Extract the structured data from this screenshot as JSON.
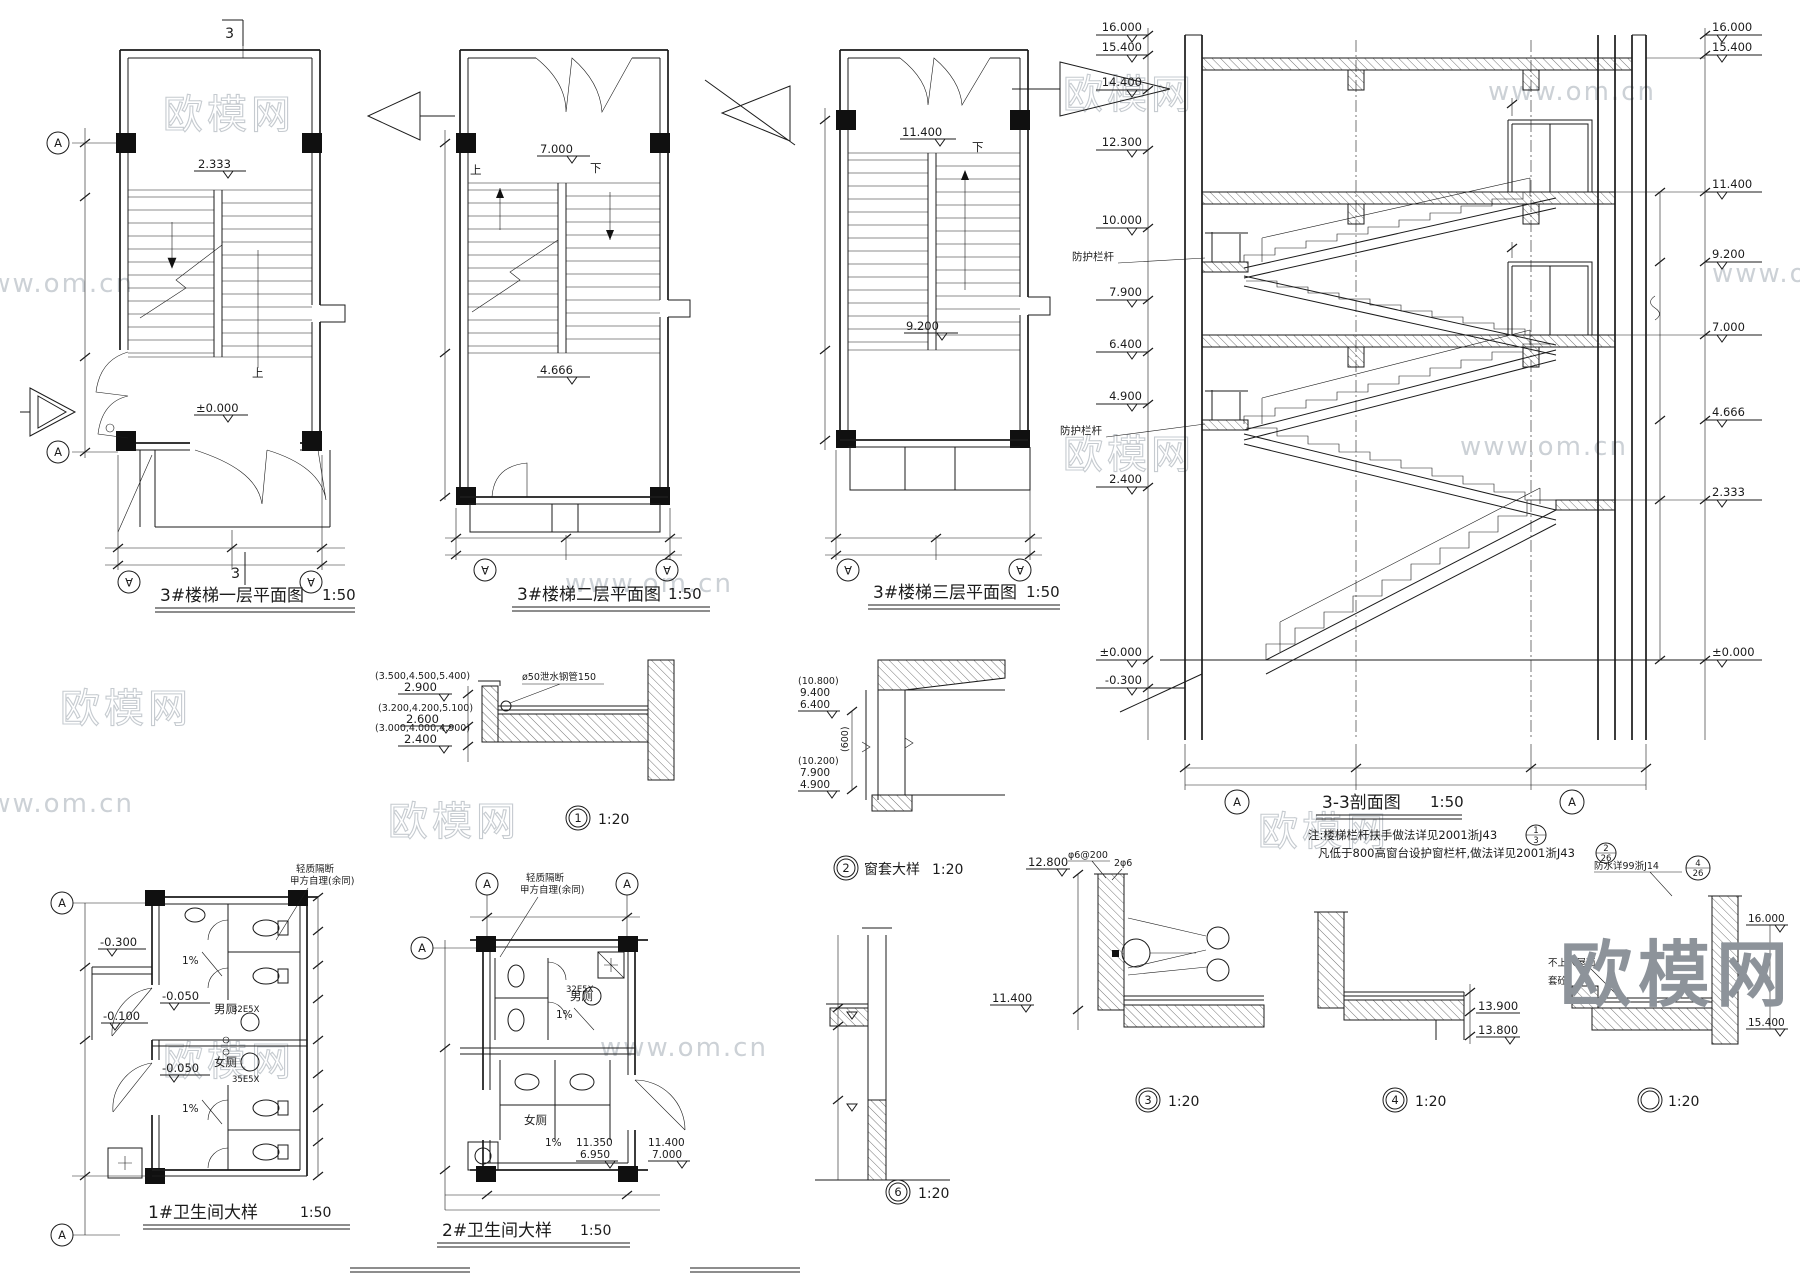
{
  "brand": {
    "name": "欧模网",
    "site": "www.om.cn"
  },
  "symbols": {
    "grid": "A",
    "section_flag": "3"
  },
  "plans": [
    {
      "title": "3#楼梯一层平面图",
      "scale": "1:50",
      "level_top": "2.333",
      "level_bottom": "±0.000",
      "dir_up": "上"
    },
    {
      "title": "3#楼梯二层平面图",
      "scale": "1:50",
      "level_top": "7.000",
      "level_bottom": "4.666",
      "dir_up": "上",
      "dir_down": "下"
    },
    {
      "title": "3#楼梯三层平面图",
      "scale": "1:50",
      "level_top": "11.400",
      "level_bottom": "9.200",
      "dir_down": "下"
    }
  ],
  "section": {
    "title": "3-3剖面图",
    "scale": "1:50",
    "left_levels": [
      "16.000",
      "15.400",
      "14.400",
      "12.300",
      "10.000",
      "7.900",
      "6.400",
      "4.900",
      "2.400",
      "±0.000",
      "-0.300"
    ],
    "right_levels": [
      "16.000",
      "15.400",
      "11.400",
      "9.200",
      "7.000",
      "4.666",
      "2.333",
      "±0.000"
    ],
    "railing": "防护栏杆",
    "notes": {
      "line1": "注:楼梯栏杆扶手做法详见2001浙J43",
      "ref1_top": "1",
      "ref1_bot": "3",
      "line2": "凡低于800高窗台设护窗栏杆,做法详见2001浙J43",
      "ref2_top": "2",
      "ref2_bot": "26"
    }
  },
  "detail1": {
    "num": "1",
    "scale": "1:20",
    "pipe": "ø50泄水钢管150",
    "rows": [
      {
        "paren": "(3.500,4.500,5.400)",
        "value": "2.900"
      },
      {
        "paren": "(3.200,4.200,5.100)",
        "value": "2.600"
      },
      {
        "paren": "(3.000,4.000,4.900)",
        "value": "2.400"
      }
    ]
  },
  "detail2": {
    "num": "2",
    "name": "窗套大样",
    "scale": "1:20",
    "top": [
      "(10.800)",
      "9.400",
      "6.400"
    ],
    "mid": "(600)",
    "bottom": [
      "(10.200)",
      "7.900",
      "4.900"
    ]
  },
  "detail3": {
    "num": "3",
    "scale": "1:20",
    "level_top": "12.800",
    "rebar_a": "φ6@200",
    "rebar_b": "2φ6",
    "level_bottom": "11.400"
  },
  "detail4": {
    "num": "4",
    "scale": "1:20",
    "level_a": "13.900",
    "level_b": "13.800"
  },
  "detail5": {
    "scale": "1:20",
    "ref": "防水详99浙J14",
    "ref_top": "4",
    "ref_bot": "26",
    "roof": "不上人屋面",
    "curb": "套砼",
    "level_a": "16.000",
    "level_b": "15.400"
  },
  "detail6": {
    "num": "6",
    "scale": "1:20"
  },
  "bath1": {
    "title": "1#卫生间大样",
    "scale": "1:50",
    "note1": "轻质隔断",
    "note2": "甲方自理(余同)",
    "levels": {
      "a": "-0.300",
      "b": "-0.050",
      "c": "-0.100",
      "d": "-0.050"
    },
    "room_m": "男厕",
    "room_f": "女厕",
    "slope": "1%",
    "tag1": "32E5X",
    "tag2": "35E5X"
  },
  "bath2": {
    "title": "2#卫生间大样",
    "scale": "1:50",
    "note1": "轻质隔断",
    "note2": "甲方自理(余同)",
    "room_m": "男厕",
    "room_f": "女厕",
    "slope": "1%",
    "tag": "32E5X",
    "lv_in_a": "11.350",
    "lv_in_b": "6.950",
    "lv_out_a": "11.400",
    "lv_out_b": "7.000"
  }
}
